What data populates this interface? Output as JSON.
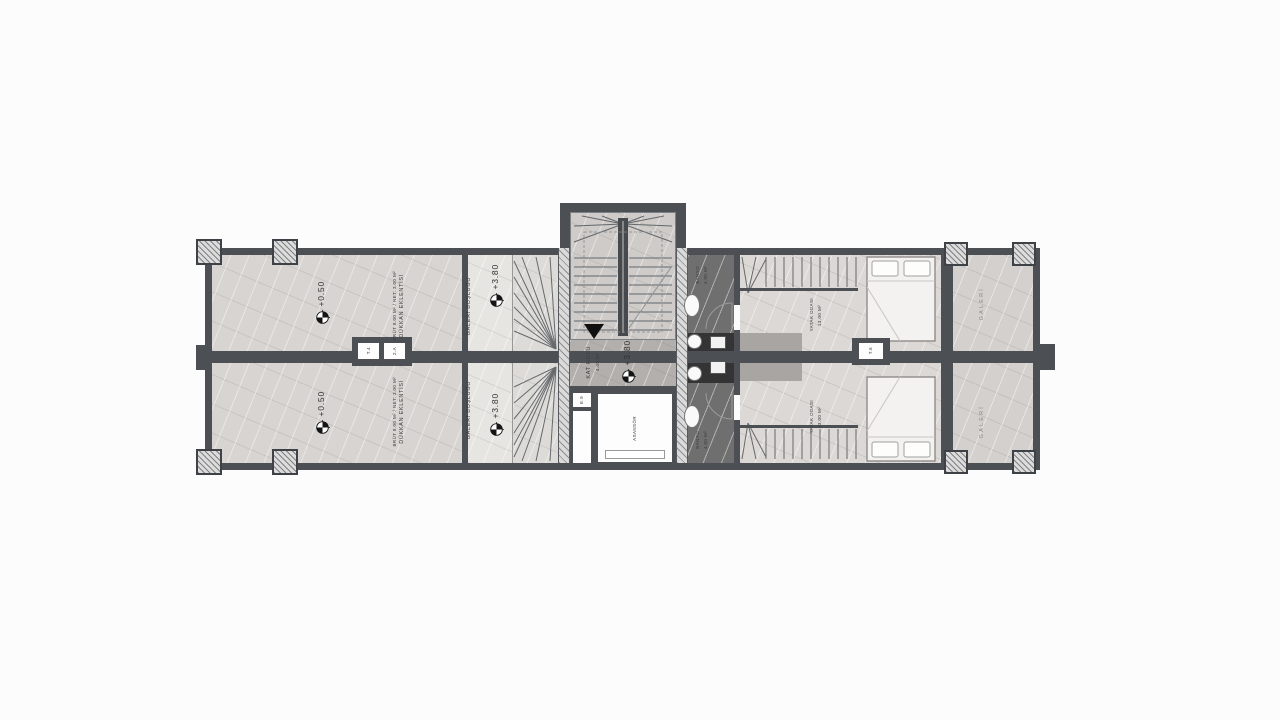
{
  "colors": {
    "wall": "#4c5055",
    "ink": "#3c3c3c",
    "floor_light": "#d7d4d1",
    "floor_void": "#e7e5e2",
    "floor_stair": "#dddbd8",
    "floor_core": "#cecbc8",
    "floor_landing": "#b2afac",
    "floor_bed": "#dbd8d5",
    "floor_gallery": "#d3d0cd",
    "floor_bath": "#6f6f6f",
    "floor_bath_dark": "#343434"
  },
  "plan": {
    "shop": {
      "level": "+0.50"
    },
    "shop_extension": {
      "label": "DÜKKAN EKLENTİSİ",
      "area": "BRÜT 8.00 M² / NET: 3.00 M²"
    },
    "gallery_void": {
      "label": "GALERİ BOŞLUĞU",
      "level": "+3.80"
    },
    "stair_hall": {
      "label": "KAT HOLÜ",
      "area": "4.00 M²",
      "level": "+3.80"
    },
    "elevator": {
      "label": "ASANSÖR"
    },
    "shaft": {
      "tag": "E.9"
    },
    "bathroom": {
      "label": "BANYO",
      "area": "4.00 M²"
    },
    "bedroom": {
      "label": "YATAK ODASI",
      "area": "13.00 M²"
    },
    "gallery": {
      "label": "GALERİ"
    },
    "wall_tags": {
      "a": "T.4",
      "b": "2.A",
      "c": "T.6"
    }
  }
}
